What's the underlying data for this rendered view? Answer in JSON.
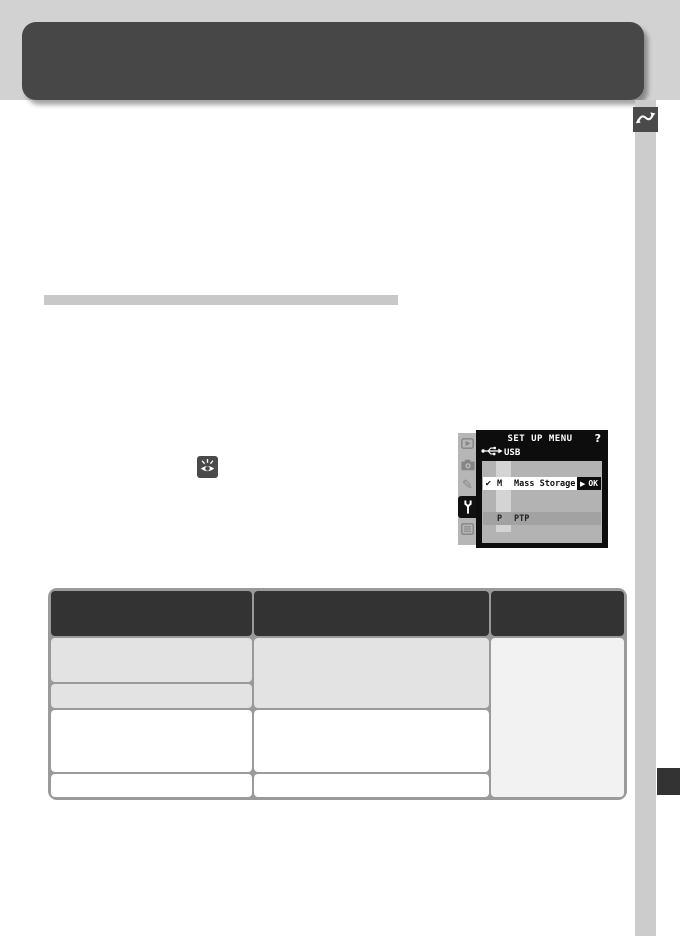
{
  "page_colors": {
    "top_band": "#d2d2d2",
    "header_bar": "#474747",
    "side_rail": "#cccccc",
    "chapter_tab": "#333333",
    "divider_bar": "#c8c8c8"
  },
  "icons": {
    "chapter": "wavy-arrow",
    "reference": "eye-with-rays",
    "usb": "usb-connector",
    "camera_menu_tabs": [
      "playback",
      "camera",
      "pencil",
      "wrench-setup",
      "menu-list"
    ],
    "selected_tab": "wrench-setup"
  },
  "camera_screen": {
    "title": "SET UP MENU",
    "help": "?",
    "menu_name": "USB",
    "options": [
      {
        "check": "✔",
        "letter": "M",
        "label": "Mass Storage",
        "confirm_arrow": "▶",
        "confirm_label": "OK"
      },
      {
        "check": "",
        "letter": "P",
        "label": "PTP",
        "confirm_arrow": "",
        "confirm_label": ""
      }
    ]
  },
  "table": {
    "columns": 3,
    "header_labels": [
      "",
      "",
      ""
    ],
    "colors": {
      "header": "#333333",
      "row_shaded": "#e3e3e3",
      "row_plain": "#ffffff",
      "side_column": "#f2f2f2",
      "border": "#9a9a9a"
    }
  }
}
